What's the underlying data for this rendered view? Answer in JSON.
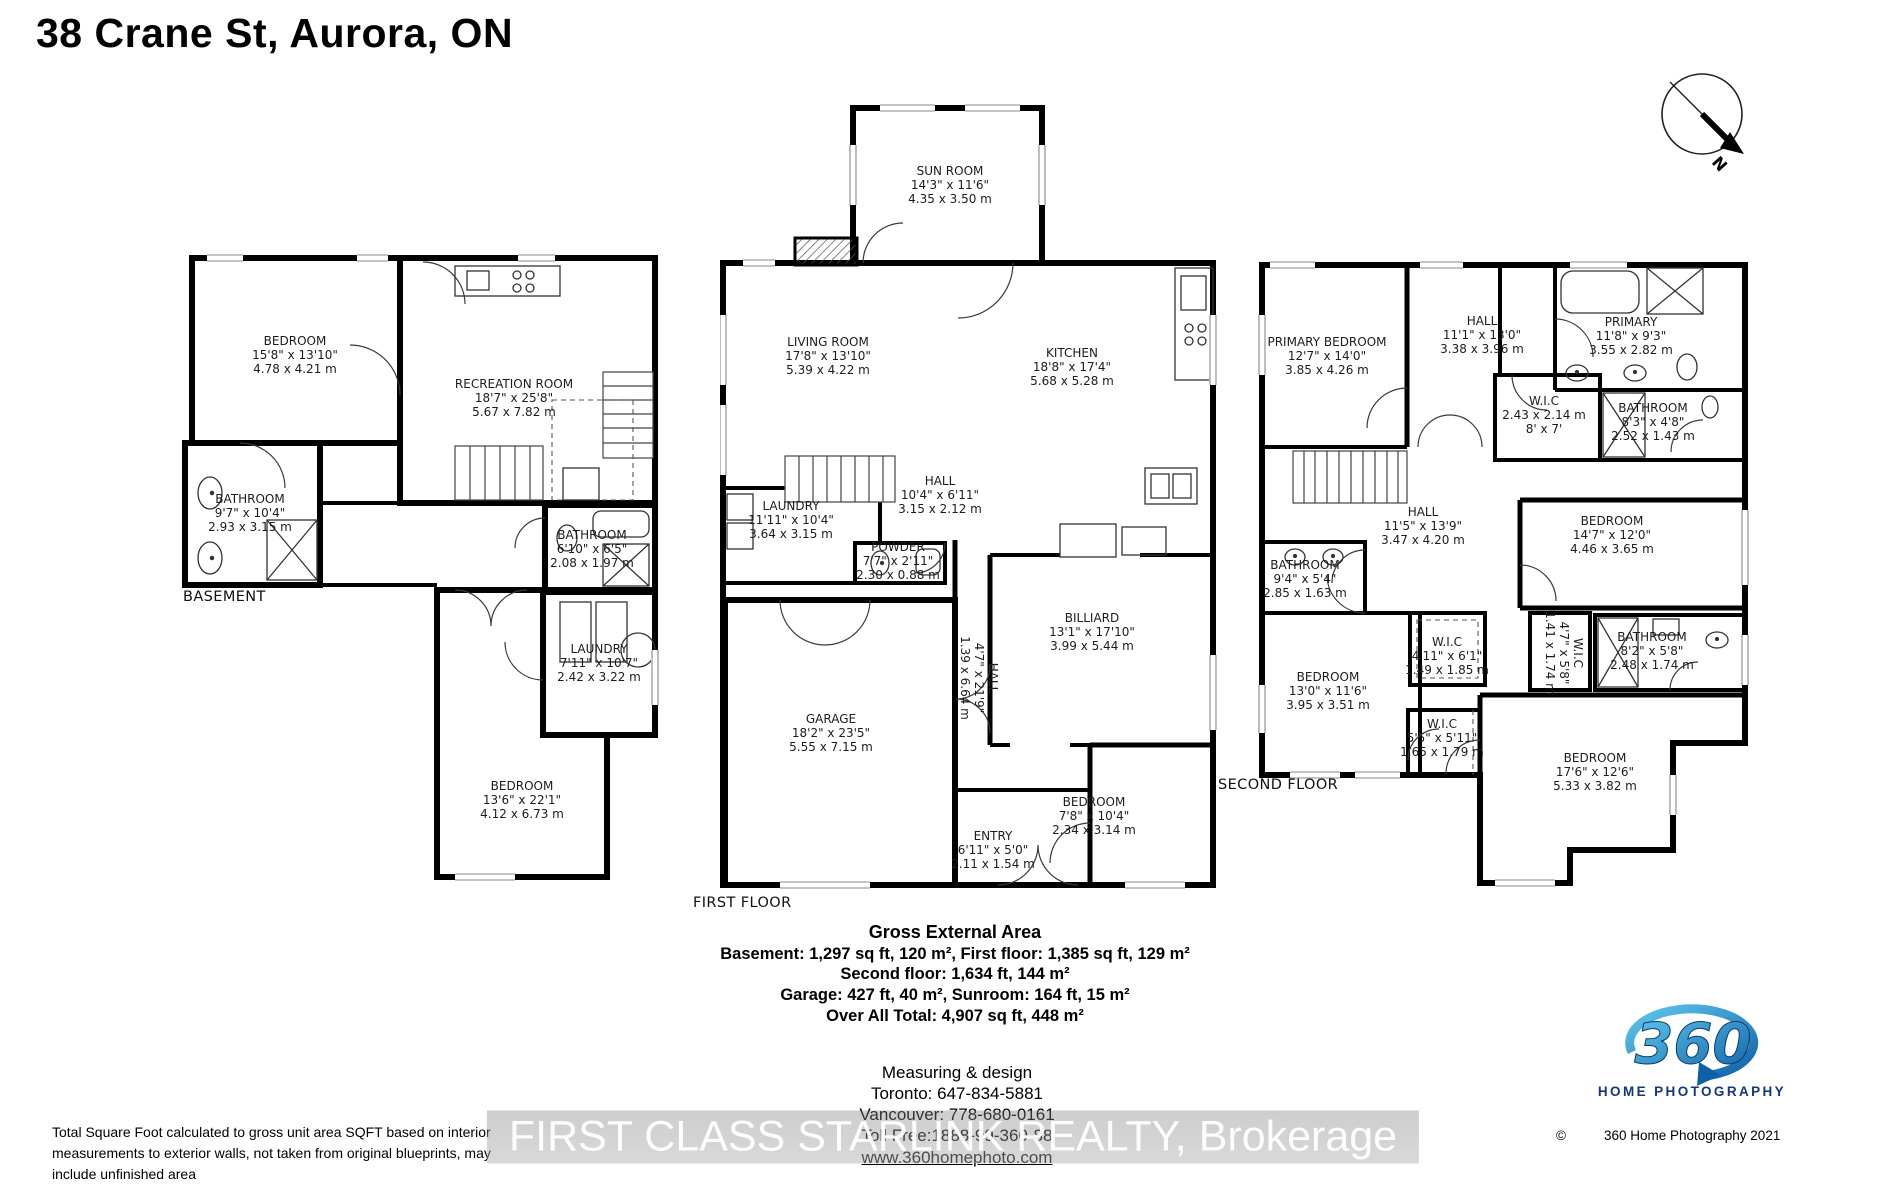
{
  "title": "38 Crane St, Aurora, ON",
  "compass": {
    "label": "N"
  },
  "plans": [
    {
      "name": "BASEMENT",
      "rooms": [
        {
          "name": "BEDROOM",
          "ft": "15'8\" x 13'10\"",
          "m": "4.78 x 4.21 m"
        },
        {
          "name": "RECREATION ROOM",
          "ft": "18'7\" x 25'8\"",
          "m": "5.67 x 7.82 m"
        },
        {
          "name": "BATHROOM",
          "ft": "9'7\" x 10'4\"",
          "m": "2.93 x 3.15 m"
        },
        {
          "name": "BATHROOM",
          "ft": "6'10\" x 6'5\"",
          "m": "2.08 x 1.97 m"
        },
        {
          "name": "LAUNDRY",
          "ft": "7'11\" x 10'7\"",
          "m": "2.42 x 3.22 m"
        },
        {
          "name": "BEDROOM",
          "ft": "13'6\" x 22'1\"",
          "m": "4.12 x 6.73 m"
        }
      ]
    },
    {
      "name": "FIRST FLOOR",
      "rooms": [
        {
          "name": "SUN ROOM",
          "ft": "14'3\" x 11'6\"",
          "m": "4.35 x 3.50 m"
        },
        {
          "name": "LIVING ROOM",
          "ft": "17'8\" x 13'10\"",
          "m": "5.39 x 4.22 m"
        },
        {
          "name": "KITCHEN",
          "ft": "18'8\" x 17'4\"",
          "m": "5.68 x 5.28 m"
        },
        {
          "name": "HALL",
          "ft": "10'4\" x 6'11\"",
          "m": "3.15 x 2.12 m"
        },
        {
          "name": "LAUNDRY",
          "ft": "11'11\" x 10'4\"",
          "m": "3.64 x 3.15 m"
        },
        {
          "name": "POWDER",
          "ft": "7'7\" x 2'11\"",
          "m": "2.30 x 0.88 m"
        },
        {
          "name": "BILLIARD",
          "ft": "13'1\" x 17'10\"",
          "m": "3.99 x 5.44 m"
        },
        {
          "name": "HALL",
          "ft": "4'7\" x 21'9\"",
          "m": "1.39 x 6.64 m"
        },
        {
          "name": "GARAGE",
          "ft": "18'2\" x 23'5\"",
          "m": "5.55 x 7.15 m"
        },
        {
          "name": "ENTRY",
          "ft": "6'11\" x 5'0\"",
          "m": "2.11 x 1.54 m"
        },
        {
          "name": "BEDROOM",
          "ft": "7'8\" x 10'4\"",
          "m": "2.34 x 3.14 m"
        }
      ]
    },
    {
      "name": "SECOND FLOOR",
      "rooms": [
        {
          "name": "PRIMARY BEDROOM",
          "ft": "12'7\" x 14'0\"",
          "m": "3.85 x 4.26 m"
        },
        {
          "name": "HALL",
          "ft": "11'1\" x 13'0\"",
          "m": "3.38 x 3.96 m"
        },
        {
          "name": "PRIMARY",
          "ft": "11'8\" x 9'3\"",
          "m": "3.55 x 2.82 m"
        },
        {
          "name": "W.I.C",
          "ft": "2.43 x 2.14 m",
          "m": "8' x 7'"
        },
        {
          "name": "BATHROOM",
          "ft": "8'3\" x 4'8\"",
          "m": "2.52 x 1.43 m"
        },
        {
          "name": "HALL",
          "ft": "11'5\" x 13'9\"",
          "m": "3.47 x 4.20 m"
        },
        {
          "name": "BATHROOM",
          "ft": "9'4\" x 5'4\"",
          "m": "2.85 x 1.63 m"
        },
        {
          "name": "BEDROOM",
          "ft": "14'7\" x 12'0\"",
          "m": "4.46 x 3.65 m"
        },
        {
          "name": "W.I.C",
          "ft": "4'11\" x 6'1\"",
          "m": "1.49 x 1.85 m"
        },
        {
          "name": "BEDROOM",
          "ft": "13'0\" x 11'6\"",
          "m": "3.95 x 3.51 m"
        },
        {
          "name": "W.I.C",
          "ft": "4'7\" x 5'8\"",
          "m": "1.41 x 1.74 m"
        },
        {
          "name": "BATHROOM",
          "ft": "8'2\" x 5'8\"",
          "m": "2.48 x 1.74 m"
        },
        {
          "name": "W.I.C",
          "ft": "5'5\" x 5'11\"",
          "m": "1.65 x 1.79 m"
        },
        {
          "name": "BEDROOM",
          "ft": "17'6\" x 12'6\"",
          "m": "5.33 x 3.82 m"
        }
      ]
    }
  ],
  "summary": {
    "title": "Gross External Area",
    "lines": [
      "Basement: 1,297 sq ft, 120 m², First floor: 1,385 sq ft, 129 m²",
      "Second floor: 1,634 ft, 144 m²",
      "Garage: 427 ft, 40 m², Sunroom: 164 ft, 15 m²",
      "Over All Total: 4,907 sq ft, 448 m²"
    ]
  },
  "contact": {
    "heading": "Measuring & design",
    "toronto": "Toronto: 647-834-5881",
    "vancouver": "Vancouver: 778-680-0161",
    "tollfree": "Toll Free:1888-99-360-88",
    "website": "www.360homephoto.com"
  },
  "watermark": "FIRST CLASS STARLINK REALTY, Brokerage",
  "disclaimer": [
    "Total Square Foot calculated to gross unit area SQFT based on interior",
    "measurements to exterior walls, not taken from original blueprints, may",
    "include unfinished area"
  ],
  "logo": {
    "number": "360",
    "name": "HOME PHOTOGRAPHY",
    "copyright": "©",
    "credit": "360 Home Photography 2021"
  },
  "colors": {
    "wall": "#000000",
    "label": "#1c1c1c",
    "logo_cyan": "#45bde5",
    "logo_navy": "#14367e",
    "watermark_band": "#9e9e9e"
  }
}
